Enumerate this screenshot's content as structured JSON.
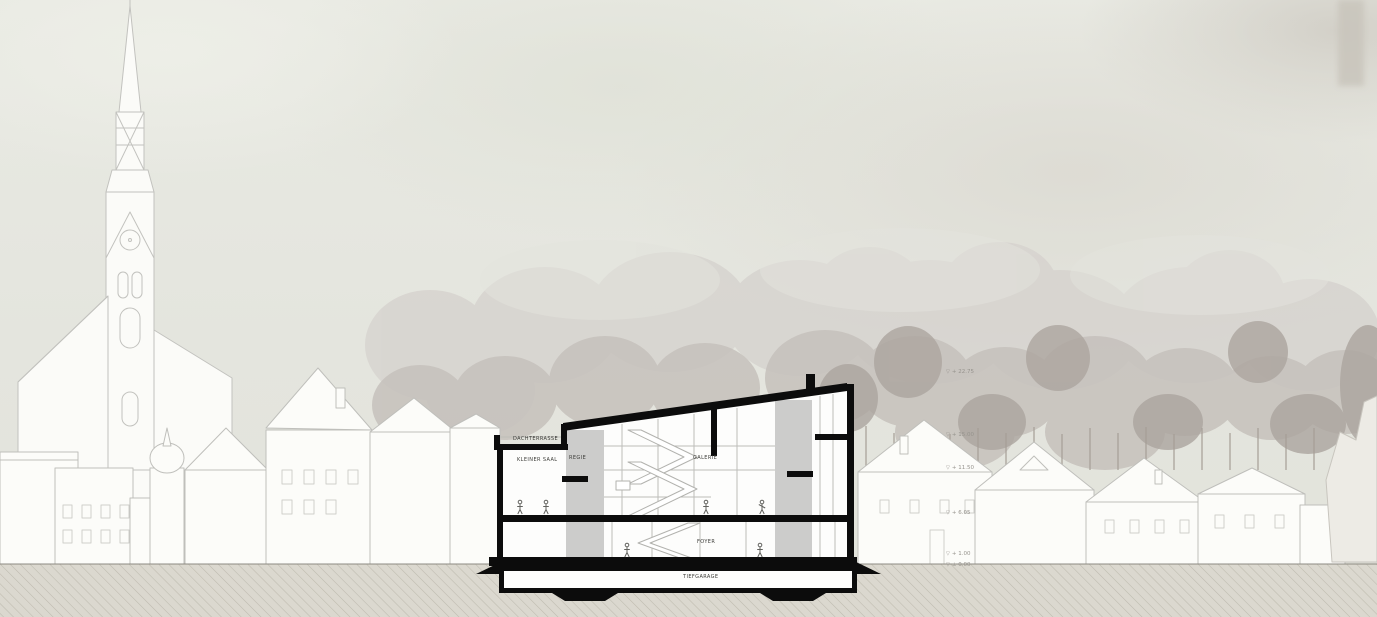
{
  "drawing": {
    "rooms": {
      "dachterrasse": "DACHTERRASSE",
      "kleiner_saal": "KLEINER SAAL",
      "regie": "REGIE",
      "galerie": "GALERIE",
      "foyer": "FOYER",
      "tiefgarage": "TIEFGARAGE"
    },
    "markers": [
      {
        "glyph": "▽",
        "value": "+ 22.75"
      },
      {
        "glyph": "▽",
        "value": "+ 15.00"
      },
      {
        "glyph": "▽",
        "value": "+ 11.50"
      },
      {
        "glyph": "▽",
        "value": "+ 6.05"
      },
      {
        "glyph": "▽",
        "value": "+ 1.00"
      },
      {
        "glyph": "▽",
        "value": "± 0.00"
      }
    ],
    "colors": {
      "section_black": "#0c0c0c",
      "core_gray": "#cccccb",
      "sky": "#e6e7e0",
      "tree_gray": "#c6c1bc",
      "ground_beige": "#dbd8cf",
      "outline_gray": "#bfbfbb",
      "label_dark": "#3c3c38",
      "label_light": "#96938d"
    }
  }
}
